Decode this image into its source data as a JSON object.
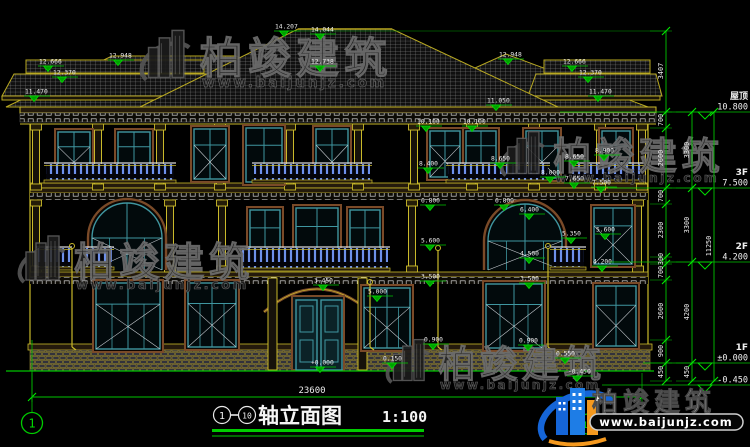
{
  "title_block": {
    "axis_start": "1",
    "axis_end": "10",
    "dash": "—",
    "title": "轴立面图",
    "scale": "1:100"
  },
  "ground_dim": {
    "total": "23600",
    "y": 397,
    "x1": 32,
    "x2": 642,
    "lx": 312
  },
  "axis_bubbles": {
    "left": "1",
    "right": "10"
  },
  "watermark": {
    "brand": "柏竣建筑",
    "url": "www.baijunjz.com"
  },
  "logo": {
    "brand": "柏竣建筑",
    "url": "www.baijunjz.com"
  },
  "colors": {
    "dim_green": "#00c400",
    "cad_yellow": "#c9b92a",
    "window_teal": "#3f96a0",
    "surround_brown": "#7a4a28",
    "baluster_blue": "#4a74e8",
    "brand_blue": "#1565d8",
    "brand_orange": "#f5991e",
    "watermark_gray": "#565656"
  },
  "floor_levels": [
    {
      "name": "屋顶",
      "value": "10.800",
      "y": 112,
      "x1": 560
    },
    {
      "name": "3F",
      "value": "7.500",
      "y": 188,
      "x1": 608
    },
    {
      "name": "2F",
      "value": "4.200",
      "y": 262,
      "x1": 610
    },
    {
      "name": "1F",
      "value": "±0.000",
      "y": 363,
      "x1": 643
    },
    {
      "name": "",
      "value": "-0.450",
      "y": 385,
      "x1": 602
    }
  ],
  "elevation_markers": [
    {
      "v": "12.666",
      "x": 48,
      "y": 66
    },
    {
      "v": "12.370",
      "x": 62,
      "y": 77
    },
    {
      "v": "11.470",
      "x": 34,
      "y": 96
    },
    {
      "v": "12.948",
      "x": 118,
      "y": 60
    },
    {
      "v": "14.207",
      "x": 284,
      "y": 31
    },
    {
      "v": "14.044",
      "x": 320,
      "y": 34
    },
    {
      "v": "12.738",
      "x": 320,
      "y": 66
    },
    {
      "v": "12.948",
      "x": 508,
      "y": 59
    },
    {
      "v": "12.666",
      "x": 572,
      "y": 66
    },
    {
      "v": "12.370",
      "x": 588,
      "y": 77
    },
    {
      "v": "11.470",
      "x": 598,
      "y": 96
    },
    {
      "v": "11.050",
      "x": 496,
      "y": 105
    },
    {
      "v": "10.100",
      "x": 426,
      "y": 126
    },
    {
      "v": "10.100",
      "x": 472,
      "y": 126
    },
    {
      "v": "8.400",
      "x": 428,
      "y": 168
    },
    {
      "v": "8.650",
      "x": 500,
      "y": 163
    },
    {
      "v": "8.650",
      "x": 574,
      "y": 161
    },
    {
      "v": "8.900",
      "x": 604,
      "y": 155
    },
    {
      "v": "8.000",
      "x": 550,
      "y": 177
    },
    {
      "v": "7.650",
      "x": 574,
      "y": 183
    },
    {
      "v": "7.500",
      "x": 601,
      "y": 187
    },
    {
      "v": "6.800",
      "x": 430,
      "y": 205
    },
    {
      "v": "6.800",
      "x": 504,
      "y": 205
    },
    {
      "v": "6.400",
      "x": 529,
      "y": 214
    },
    {
      "v": "5.600",
      "x": 430,
      "y": 245
    },
    {
      "v": "5.600",
      "x": 605,
      "y": 234
    },
    {
      "v": "5.350",
      "x": 571,
      "y": 238
    },
    {
      "v": "4.500",
      "x": 529,
      "y": 258
    },
    {
      "v": "4.200",
      "x": 602,
      "y": 266
    },
    {
      "v": "3.500",
      "x": 430,
      "y": 281
    },
    {
      "v": "3.500",
      "x": 529,
      "y": 283
    },
    {
      "v": "3.450",
      "x": 323,
      "y": 285
    },
    {
      "v": "5.000",
      "x": 377,
      "y": 296
    },
    {
      "v": "0.900",
      "x": 433,
      "y": 344
    },
    {
      "v": "0.900",
      "x": 528,
      "y": 345
    },
    {
      "v": "0.550",
      "x": 565,
      "y": 358
    },
    {
      "v": "0.150",
      "x": 392,
      "y": 363
    },
    {
      "v": "+0.000",
      "x": 320,
      "y": 367
    },
    {
      "v": "-0.450",
      "x": 577,
      "y": 376
    }
  ],
  "dim_chains": [
    {
      "x": 666,
      "ticks": [
        31,
        112,
        128,
        188,
        204,
        257,
        264,
        280,
        340,
        363,
        381
      ],
      "labels": [
        [
          "3407",
          71
        ],
        [
          "700",
          120
        ],
        [
          "2600",
          158
        ],
        [
          "700",
          196
        ],
        [
          "2300",
          230
        ],
        [
          "300",
          259
        ],
        [
          "700",
          272
        ],
        [
          "2600",
          311
        ],
        [
          "900",
          351
        ],
        [
          "450",
          372
        ]
      ]
    },
    {
      "x": 692,
      "ticks": [
        112,
        188,
        262,
        363,
        381
      ],
      "labels": [
        [
          "3300",
          150
        ],
        [
          "3300",
          225
        ],
        [
          "4200",
          312
        ],
        [
          "450",
          372
        ]
      ]
    },
    {
      "x": 714,
      "ticks": [
        112,
        381
      ],
      "labels": [
        [
          "11250",
          246
        ]
      ]
    }
  ],
  "ext_lines": [
    {
      "x1": 286,
      "y1": 31,
      "x2": 666,
      "y2": 31
    }
  ]
}
